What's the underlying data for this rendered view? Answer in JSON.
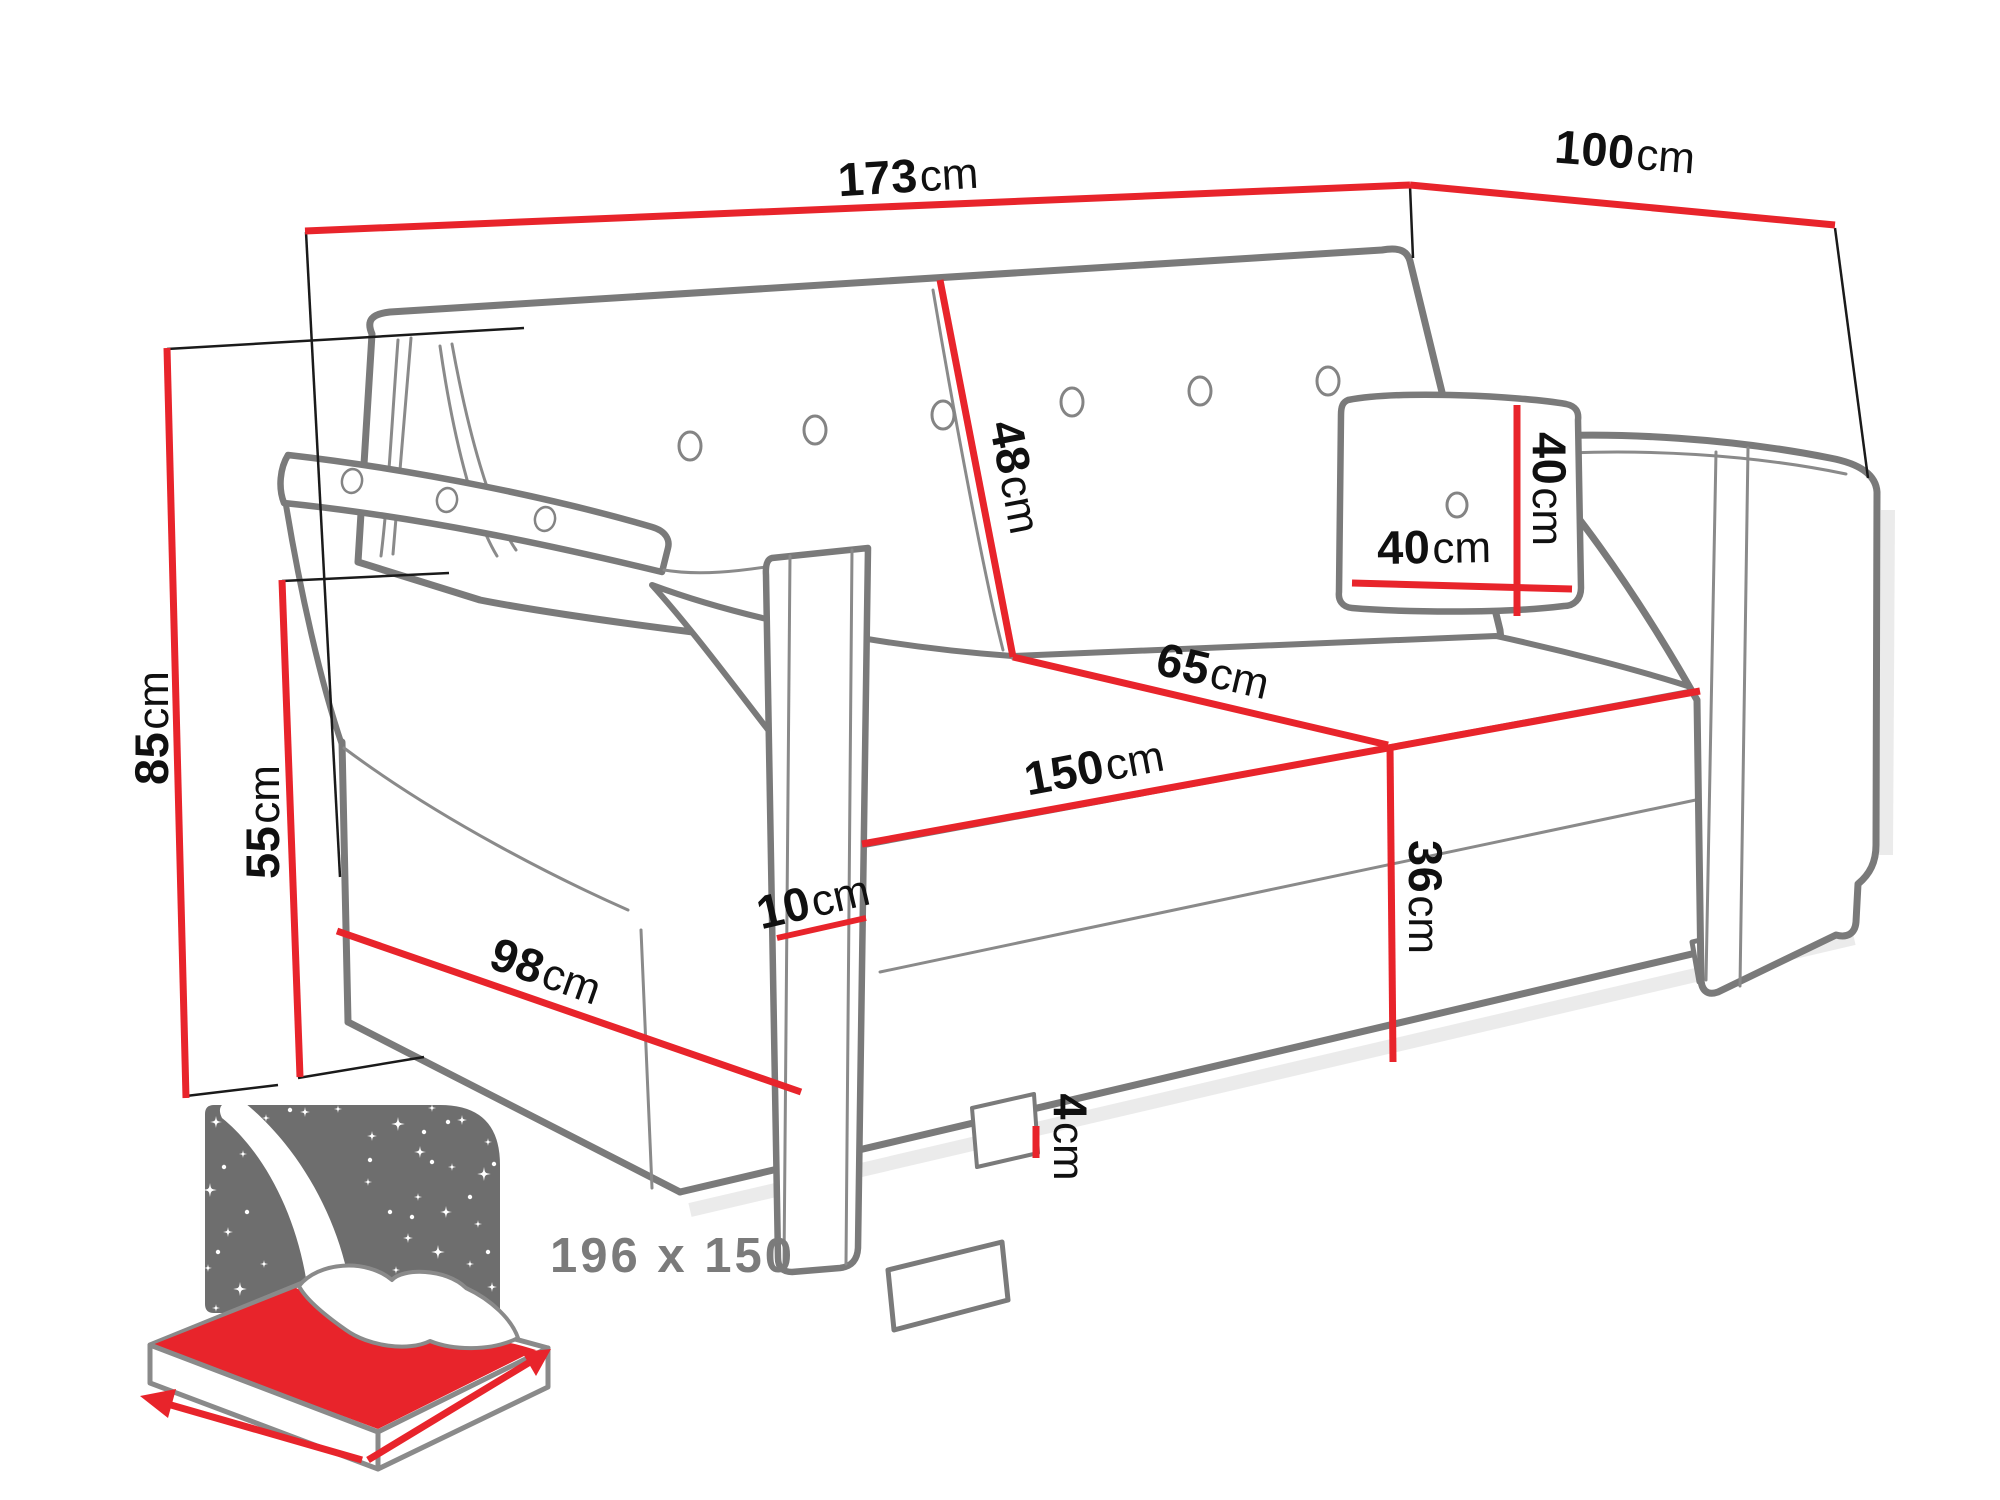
{
  "diagram_labels": {
    "overall_width": {
      "v": "173",
      "u": "cm"
    },
    "overall_depth": {
      "v": "100",
      "u": "cm"
    },
    "overall_height": {
      "v": "85",
      "u": "cm"
    },
    "armrest_height": {
      "v": "55",
      "u": "cm"
    },
    "backrest_length": {
      "v": "48",
      "u": "cm"
    },
    "pillow_width": {
      "v": "40",
      "u": "cm"
    },
    "pillow_height": {
      "v": "40",
      "u": "cm"
    },
    "seat_depth": {
      "v": "65",
      "u": "cm"
    },
    "seat_width": {
      "v": "150",
      "u": "cm"
    },
    "seat_height": {
      "v": "36",
      "u": "cm"
    },
    "armrest_width": {
      "v": "10",
      "u": "cm"
    },
    "base_length": {
      "v": "98",
      "u": "cm"
    },
    "leg_height": {
      "v": "4",
      "u": "cm"
    }
  },
  "sleeping_area_label": "196 x 150",
  "colors": {
    "dimension_red": "#e8242b",
    "outline_gray": "#7a7a7a",
    "extension_black": "#1a1a1a",
    "label_black": "#101010",
    "sleeping_gray": "#7b7b7b",
    "night_panel_gray": "#6e6e6e"
  }
}
